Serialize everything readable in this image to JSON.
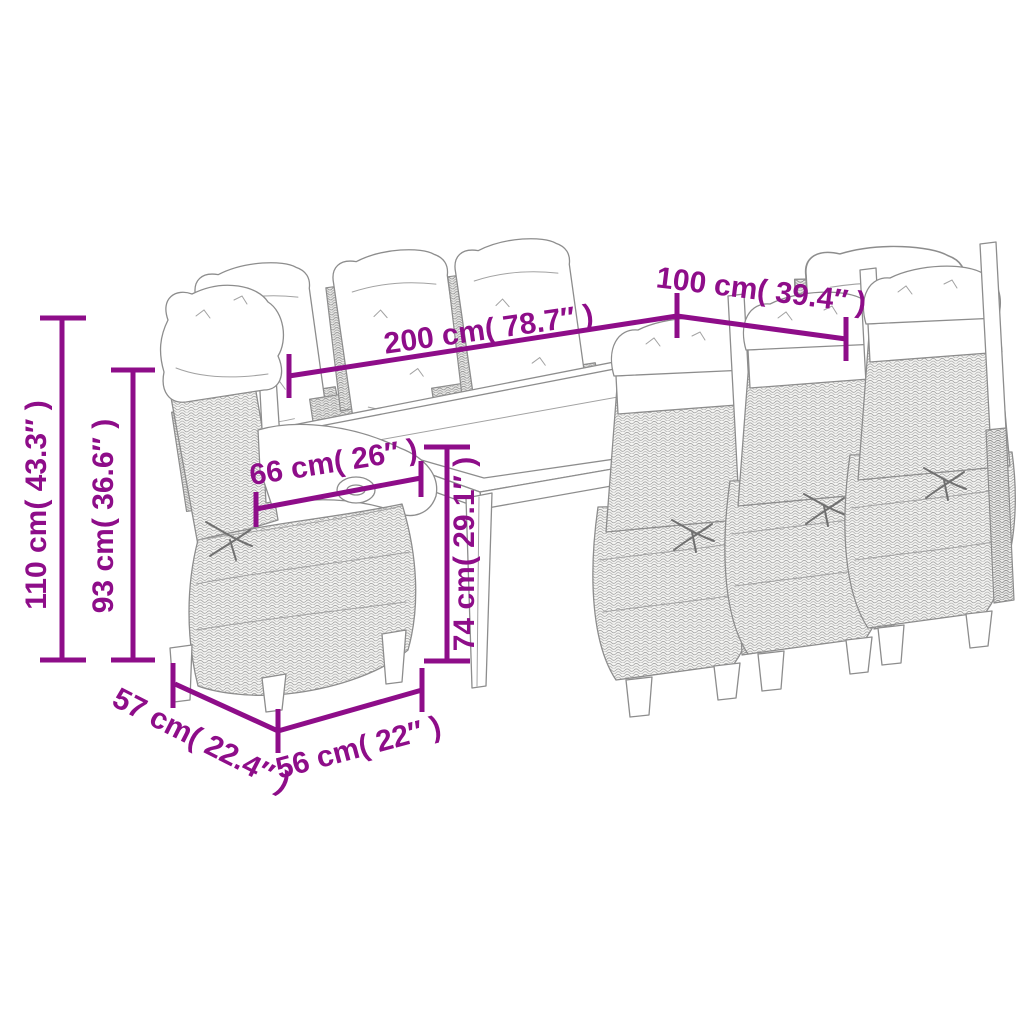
{
  "colors": {
    "accent_purple": "#8e0d89",
    "line_art_gray": "#8d8d8d",
    "background": "#ffffff"
  },
  "illustration": {
    "caption": "9-piece rattan garden dining set line drawing: glass-top table with eight reclining cushioned chairs"
  },
  "dimensions": {
    "overall_height": {
      "cm": 110,
      "inches": 43.3,
      "label": "110 cm( 43.3″ )"
    },
    "back_height": {
      "cm": 93,
      "inches": 36.6,
      "label": "93 cm( 36.6″ )"
    },
    "table_height": {
      "cm": 74,
      "inches": 29.1,
      "label": "74 cm( 29.1″ )"
    },
    "table_length": {
      "cm": 200,
      "inches": 78.7,
      "label": "200 cm( 78.7″ )"
    },
    "table_width": {
      "cm": 100,
      "inches": 39.4,
      "label": "100 cm( 39.4″ )"
    },
    "armrest_width": {
      "cm": 66,
      "inches": 26,
      "label": "66 cm( 26″ )"
    },
    "seat_depth": {
      "cm": 57,
      "inches": 22.4,
      "label": "57 cm( 22.4″ )"
    },
    "seat_width": {
      "cm": 56,
      "inches": 22,
      "label": "56 cm( 22″ )"
    }
  }
}
